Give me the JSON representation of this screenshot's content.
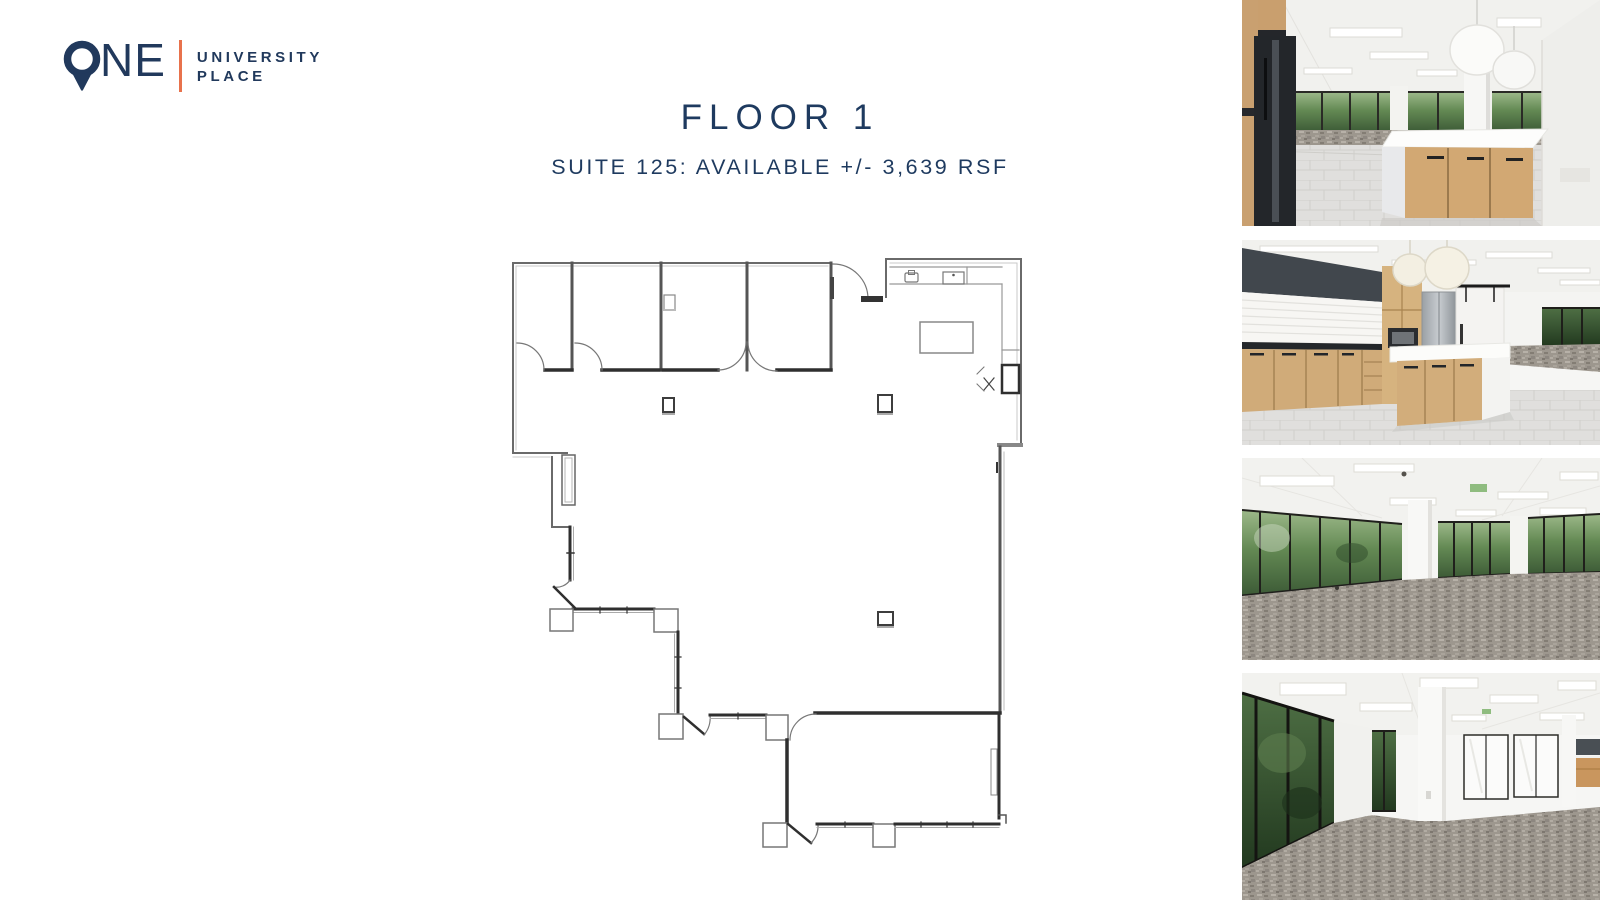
{
  "logo": {
    "name": "ONE",
    "name_rest": "NE",
    "line1": "UNIVERSITY",
    "line2": "PLACE"
  },
  "header": {
    "title": "FLOOR 1",
    "subtitle": "SUITE 125: AVAILABLE +/- 3,639 RSF"
  },
  "floor_plan": {
    "floor": "FLOOR 1",
    "suite": "SUITE 125",
    "availability": "AVAILABLE",
    "area_rsf": "3,639"
  },
  "photos": [
    {
      "name": "kitchen-island-photo"
    },
    {
      "name": "kitchen-counter-photo"
    },
    {
      "name": "open-office-windows-photo",
      "signage": "EXIT"
    },
    {
      "name": "open-office-column-photo"
    }
  ],
  "colors": {
    "navy": "#1e3a5f",
    "orange": "#e8724c",
    "plan_wall": "#666666",
    "plan_bold_wall": "#2f2f2f"
  }
}
